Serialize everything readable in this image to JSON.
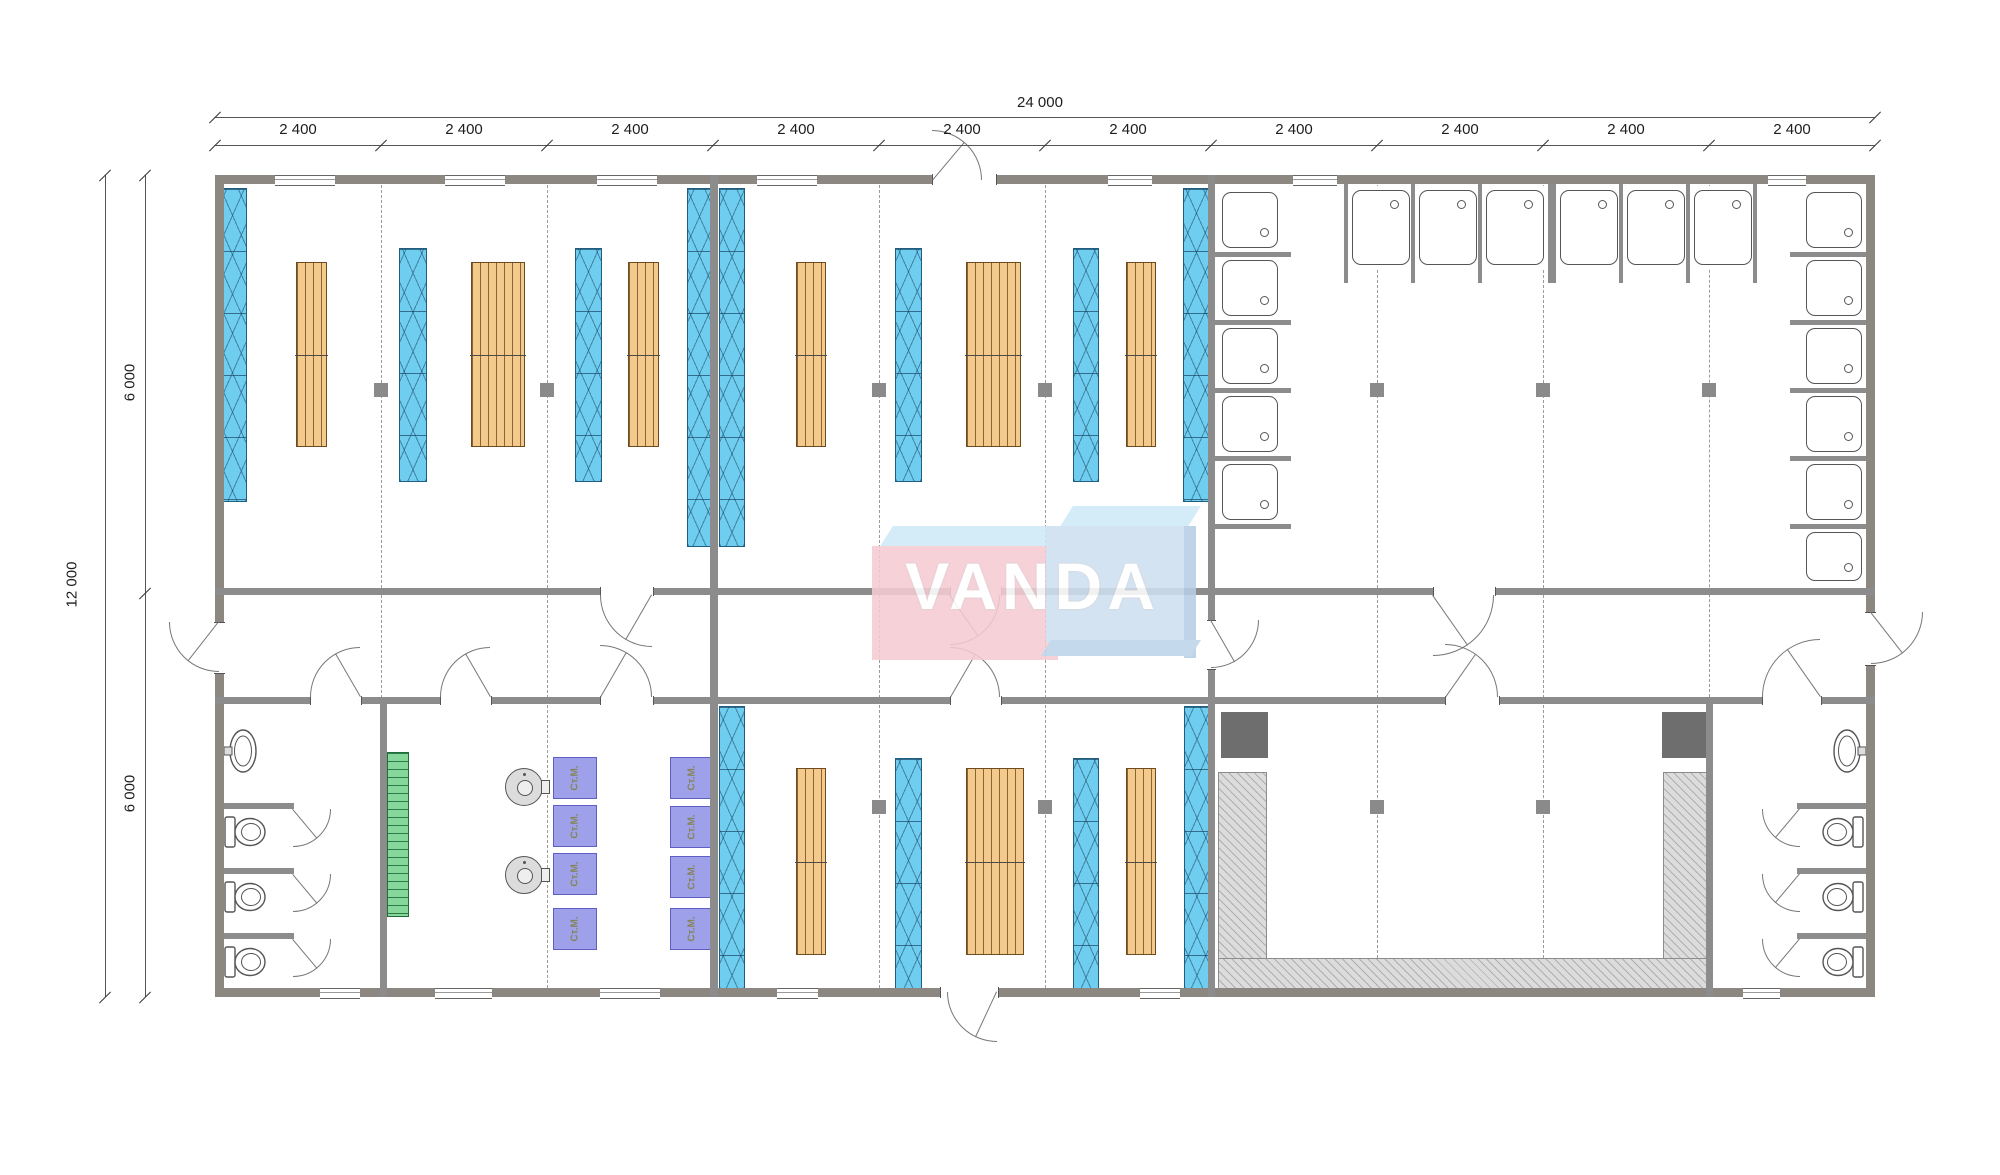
{
  "dimensions": {
    "overall_width": "24 000",
    "overall_depth": "12 000",
    "depth_top": "6 000",
    "depth_bottom": "6 000",
    "top_segments": [
      "2 400",
      "2 400",
      "2 400",
      "2 400",
      "2 400",
      "2 400",
      "2 400",
      "2 400",
      "2 400",
      "2 400"
    ]
  },
  "logo": {
    "text": "VANDA"
  },
  "equipment": {
    "washing_machine_label": "Ст.М."
  },
  "colors": {
    "wall_exterior": "#8d8781",
    "wall_interior": "#8c8c8c",
    "insulated_panel_blue": "#6fcdf0",
    "bunk_rack_orange": "#f4c98c",
    "ladder_green": "#86d89a",
    "washer_purple": "#9ea0ea",
    "counter_hatch_gray": "#dcdcdc",
    "logo_pink": "#f5cbd3",
    "logo_blue": "#cfe0f1",
    "logo_top_blue": "#cfeaf8"
  }
}
